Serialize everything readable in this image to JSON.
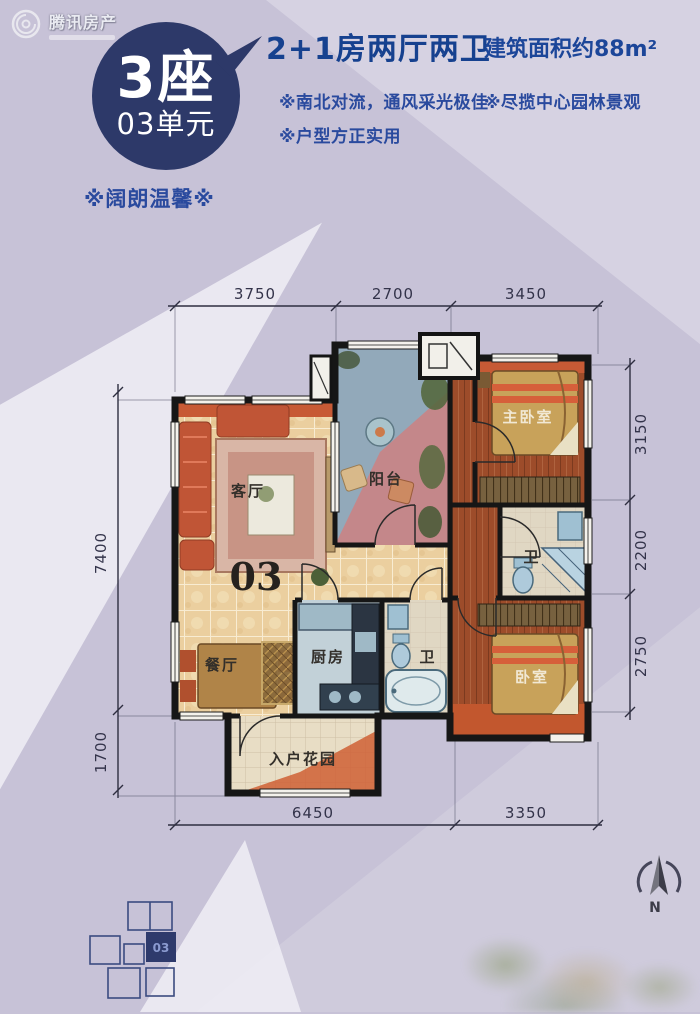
{
  "watermark": {
    "brand": "腾讯房产"
  },
  "header": {
    "block_label": "3座",
    "unit_label": "03单元",
    "tagline": "※阔朗温馨※",
    "title": "2+1房两厅两卫",
    "area": "建筑面积约88m²",
    "features": [
      "※南北对流，通风采光极佳",
      "※尽揽中心园林景观",
      "※户型方正实用"
    ]
  },
  "floorplan": {
    "unit_number": "03",
    "labels": {
      "living": "客厅",
      "balcony": "阳台",
      "master": "主卧室",
      "bath_a": "卫",
      "bedroom": "卧室",
      "dining": "餐厅",
      "kitchen": "厨房",
      "bath_b": "卫",
      "garden": "入户花园"
    },
    "dims": {
      "top": [
        "3750",
        "2700",
        "3450"
      ],
      "right": [
        "3150",
        "2200",
        "2750"
      ],
      "left": [
        "7400",
        "1700"
      ],
      "bottom": [
        "6450",
        "3350"
      ]
    }
  },
  "keyplan": {
    "unit_label": "03"
  },
  "compass": {
    "label": "N"
  },
  "colors": {
    "accent_navy": "#2d3969",
    "text_blue": "#1c4699",
    "wall_black": "#161616",
    "accent_orange": "#c75a35",
    "tile_cream": "#ebcf9f",
    "balcony_blue": "#92a9ba",
    "balcony_pink": "#c4878a",
    "wood_red": "#9d4c2a"
  }
}
